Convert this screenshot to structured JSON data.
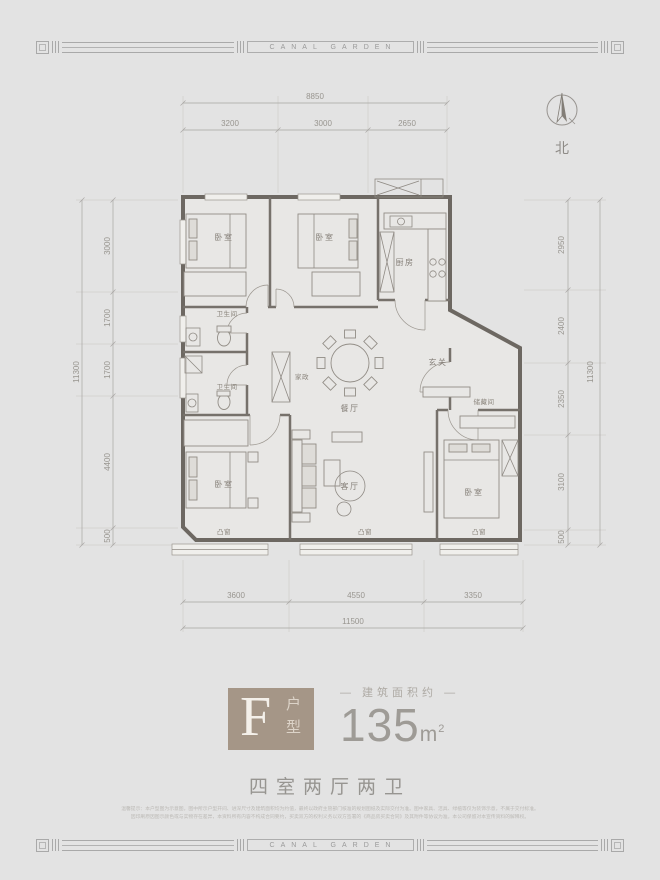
{
  "brand": {
    "name": "CANAL GARDEN"
  },
  "compass": {
    "label": "北"
  },
  "unit": {
    "letter": "F",
    "type_label": "户型",
    "area_prefix": "— 建筑面积约 —",
    "area_value": "135",
    "area_unit": "m",
    "area_unit_sup": "2",
    "rooms_summary": "四室两厅两卫"
  },
  "dimensions": {
    "top": {
      "total": "8850",
      "segments": [
        "3200",
        "3000",
        "2650"
      ]
    },
    "left": {
      "total": "11300",
      "segments": [
        "3000",
        "1700",
        "1700",
        "4400",
        "500"
      ]
    },
    "right": {
      "total": "11300",
      "segments": [
        "2950",
        "2400",
        "2350",
        "3100",
        "500"
      ]
    },
    "bottom": {
      "total": "11500",
      "segments": [
        "3600",
        "4550",
        "3350"
      ]
    }
  },
  "rooms": {
    "bedroom_top_left": "卧室",
    "bedroom_top_mid": "卧室",
    "kitchen": "厨房",
    "bath_upper": "卫生间",
    "bath_lower": "卫生间",
    "laundry": "家政",
    "dining": "餐厅",
    "foyer": "玄关",
    "storage": "储藏间",
    "living": "客厅",
    "bedroom_bottom_left": "卧室",
    "bedroom_bottom_right": "卧室",
    "bay_left": "凸窗",
    "bay_center": "凸窗",
    "bay_right": "凸窗"
  },
  "disclaimer": {
    "line1": "温馨提示：本户型图为示意图，图中所示户型开间、进深尺寸及建筑面积均为约值，最终以政府主管部门核准的规划图纸及实际交付为准。图中家具、洁具、绿植等仅为装饰示意，不属于交付标准。",
    "line2": "因印刷原因图示颜色或与实物存在差异，本资料所有内容不构成合同要约，买卖双方的权利义务以双方签署的《商品房买卖合同》及其附件等协议为准。本公司保留对本宣传资料的解释权。"
  }
}
